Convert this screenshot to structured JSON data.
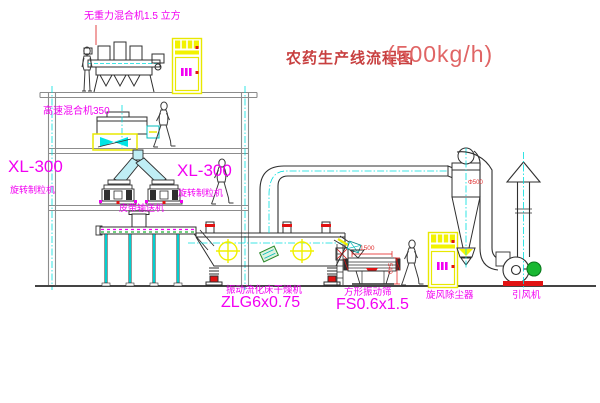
{
  "title": {
    "text": "农药生产线流程图",
    "capacity": "(500kg/h)"
  },
  "labels": {
    "gravity_mixer": "无重力混合机1.5 立方",
    "high_speed_mixer": "高速混合机350",
    "xl300_left": "XL-300",
    "granulator_left": "旋转制粒机",
    "xl300_mid": "XL-300",
    "granulator_mid": "旋转制粒机",
    "belt_conveyor": "皮带输送机",
    "dryer_name": "振动流化床干燥机",
    "dryer_model": "ZLG6x0.75",
    "sieve_name": "方形振动筛",
    "sieve_model": "FS0.6x1.5",
    "cyclone": "旋风除尘器",
    "fan": "引风机"
  },
  "dimensions": {
    "sieve_length": "1500",
    "sieve_height": "540",
    "cyclone_diameter": "Φ500"
  },
  "colors": {
    "label_magenta": "#f200f2",
    "title_red": "#c84040",
    "accent_yellow": "#f2f200",
    "centerline_cyan": "#00dede",
    "structure_gray": "#8c8c8c",
    "machine_dark": "#2f2f2f",
    "highlight_red": "#e11313",
    "motor_green": "#18b832"
  }
}
